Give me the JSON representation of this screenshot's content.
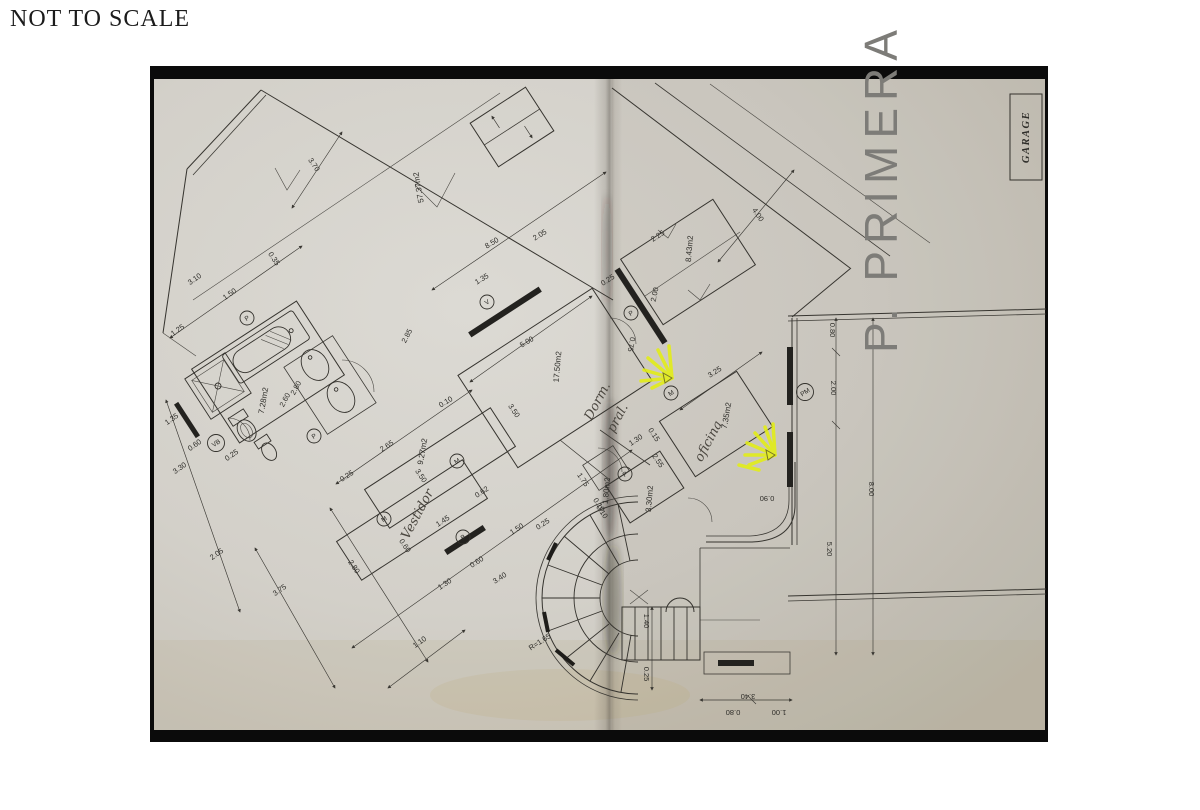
{
  "page": {
    "scale_note": "NOT TO SCALE"
  },
  "plan": {
    "floor_title": "P. PRIMERA",
    "garage_label": "GARAGE",
    "colors": {
      "paper": "#d7d4cd",
      "paper_shadow": "#c7c3b9",
      "photo_background": "#0b0b0b",
      "ink": "#36342f",
      "highlighter": "#e3ee14",
      "pencil": "#4a463f"
    },
    "rooms": [
      {
        "area": "57.37m2",
        "name": ""
      },
      {
        "area": "17.50m2",
        "name": "Dorm. pral. (handwritten)"
      },
      {
        "area": "8.43m2",
        "name": ""
      },
      {
        "area": "7.28m2",
        "name": "bathroom"
      },
      {
        "area": "9.27m2",
        "name": ""
      },
      {
        "area": "7.35m2",
        "name": "oficina (handwritten)"
      },
      {
        "area": "3.30m2",
        "name": ""
      },
      {
        "area": "1.80m2",
        "name": ""
      },
      {
        "area": "",
        "name": "Vestidor (handwritten)"
      },
      {
        "area": "",
        "name": "GARAGE"
      }
    ],
    "area_labels": [
      {
        "t": "57.37m2",
        "x": 421,
        "y": 187,
        "r": -100
      },
      {
        "t": "8.43m2",
        "x": 692,
        "y": 249,
        "r": -85
      },
      {
        "t": "17.50m2",
        "x": 560,
        "y": 367,
        "r": -85
      },
      {
        "t": "7.28m2",
        "x": 266,
        "y": 401,
        "r": -80
      },
      {
        "t": "9.27m2",
        "x": 425,
        "y": 452,
        "r": -80
      },
      {
        "t": "7.35m2",
        "x": 729,
        "y": 416,
        "r": -80
      },
      {
        "t": "3.30m2",
        "x": 652,
        "y": 499,
        "r": -85
      },
      {
        "t": "1.80m2",
        "x": 609,
        "y": 491,
        "r": -85
      }
    ],
    "hand_labels": [
      {
        "t": "Dorm.",
        "x": 601,
        "y": 403,
        "r": -62
      },
      {
        "t": "pral.",
        "x": 621,
        "y": 420,
        "r": -62
      },
      {
        "t": "oficina",
        "x": 712,
        "y": 443,
        "r": -62
      },
      {
        "t": "Vestidor",
        "x": 421,
        "y": 516,
        "r": -62
      }
    ],
    "dim_labels": [
      {
        "t": "3.70",
        "x": 312,
        "y": 166,
        "r": 56
      },
      {
        "t": "0.35",
        "x": 272,
        "y": 260,
        "r": 56
      },
      {
        "t": "3.10",
        "x": 196,
        "y": 281,
        "r": -35
      },
      {
        "t": "1.50",
        "x": 231,
        "y": 296,
        "r": -35
      },
      {
        "t": "1.25",
        "x": 179,
        "y": 332,
        "r": -35
      },
      {
        "t": "8.50",
        "x": 493,
        "y": 245,
        "r": -31
      },
      {
        "t": "2.05",
        "x": 541,
        "y": 237,
        "r": -31
      },
      {
        "t": "1.35",
        "x": 483,
        "y": 281,
        "r": -31
      },
      {
        "t": "0.25",
        "x": 609,
        "y": 282,
        "r": -33
      },
      {
        "t": "2.25",
        "x": 659,
        "y": 238,
        "r": -33
      },
      {
        "t": "4.00",
        "x": 756,
        "y": 216,
        "r": 56
      },
      {
        "t": "2.00",
        "x": 657,
        "y": 295,
        "r": -78
      },
      {
        "t": "0.75",
        "x": 629,
        "y": 344,
        "r": 100
      },
      {
        "t": "3.25",
        "x": 716,
        "y": 374,
        "r": -33
      },
      {
        "t": "0.80",
        "x": 830,
        "y": 330,
        "r": 90
      },
      {
        "t": "2.00",
        "x": 831,
        "y": 388,
        "r": 90
      },
      {
        "t": "8.00",
        "x": 869,
        "y": 489,
        "r": 90
      },
      {
        "t": "5.20",
        "x": 827,
        "y": 549,
        "r": 90
      },
      {
        "t": "2.85",
        "x": 409,
        "y": 337,
        "r": -62
      },
      {
        "t": "5.00",
        "x": 528,
        "y": 344,
        "r": -31
      },
      {
        "t": "0.10",
        "x": 447,
        "y": 404,
        "r": -31
      },
      {
        "t": "3.50",
        "x": 512,
        "y": 412,
        "r": 56
      },
      {
        "t": "2.60",
        "x": 287,
        "y": 401,
        "r": -62
      },
      {
        "t": "2.80",
        "x": 298,
        "y": 389,
        "r": -62
      },
      {
        "t": "0.25",
        "x": 233,
        "y": 457,
        "r": -35
      },
      {
        "t": "1.35",
        "x": 173,
        "y": 421,
        "r": -35
      },
      {
        "t": "0.60",
        "x": 196,
        "y": 447,
        "r": -35
      },
      {
        "t": "3.30",
        "x": 181,
        "y": 470,
        "r": -35
      },
      {
        "t": "2.05",
        "x": 218,
        "y": 556,
        "r": -35
      },
      {
        "t": "2.65",
        "x": 388,
        "y": 448,
        "r": -33
      },
      {
        "t": "3.50",
        "x": 419,
        "y": 477,
        "r": 56
      },
      {
        "t": "0.25",
        "x": 348,
        "y": 478,
        "r": -33
      },
      {
        "t": "1.45",
        "x": 444,
        "y": 523,
        "r": -33
      },
      {
        "t": "0.62",
        "x": 483,
        "y": 494,
        "r": -33
      },
      {
        "t": "0.60",
        "x": 403,
        "y": 547,
        "r": 56
      },
      {
        "t": "1.30",
        "x": 446,
        "y": 586,
        "r": -33
      },
      {
        "t": "0.60",
        "x": 478,
        "y": 564,
        "r": -33
      },
      {
        "t": "3.40",
        "x": 501,
        "y": 580,
        "r": -33
      },
      {
        "t": "1.50",
        "x": 518,
        "y": 531,
        "r": -33
      },
      {
        "t": "0.25",
        "x": 544,
        "y": 526,
        "r": -33
      },
      {
        "t": "2.80",
        "x": 352,
        "y": 568,
        "r": 56
      },
      {
        "t": "3.75",
        "x": 281,
        "y": 592,
        "r": -35
      },
      {
        "t": "1.10",
        "x": 421,
        "y": 644,
        "r": -35
      },
      {
        "t": "1.30",
        "x": 637,
        "y": 442,
        "r": -33
      },
      {
        "t": "0.15",
        "x": 652,
        "y": 436,
        "r": 56
      },
      {
        "t": "2.55",
        "x": 656,
        "y": 462,
        "r": 56
      },
      {
        "t": "1.75",
        "x": 581,
        "y": 481,
        "r": 56
      },
      {
        "t": "0.10",
        "x": 597,
        "y": 506,
        "r": 56
      },
      {
        "t": "0.90",
        "x": 767,
        "y": 496,
        "r": 180
      },
      {
        "t": "R=1.65",
        "x": 541,
        "y": 644,
        "r": -33
      },
      {
        "t": "1.40",
        "x": 644,
        "y": 621,
        "r": 90
      },
      {
        "t": "0.25",
        "x": 644,
        "y": 674,
        "r": 90
      },
      {
        "t": "0.10",
        "x": 600,
        "y": 513,
        "r": 56
      },
      {
        "t": "0.80",
        "x": 733,
        "y": 710,
        "r": 180
      },
      {
        "t": "1.00",
        "x": 779,
        "y": 710,
        "r": 180
      },
      {
        "t": "3.40",
        "x": 748,
        "y": 694,
        "r": 180
      }
    ],
    "door_window_marks": [
      {
        "t": "V",
        "x": 487,
        "y": 302
      },
      {
        "t": "P",
        "x": 247,
        "y": 318
      },
      {
        "t": "VB",
        "x": 216,
        "y": 443
      },
      {
        "t": "P",
        "x": 314,
        "y": 436
      },
      {
        "t": "M",
        "x": 384,
        "y": 519
      },
      {
        "t": "M",
        "x": 457,
        "y": 461
      },
      {
        "t": "B",
        "x": 463,
        "y": 537
      },
      {
        "t": "P",
        "x": 631,
        "y": 313
      },
      {
        "t": "M",
        "x": 671,
        "y": 393
      },
      {
        "t": "PM",
        "x": 805,
        "y": 392
      },
      {
        "t": "P",
        "x": 625,
        "y": 474
      }
    ]
  }
}
